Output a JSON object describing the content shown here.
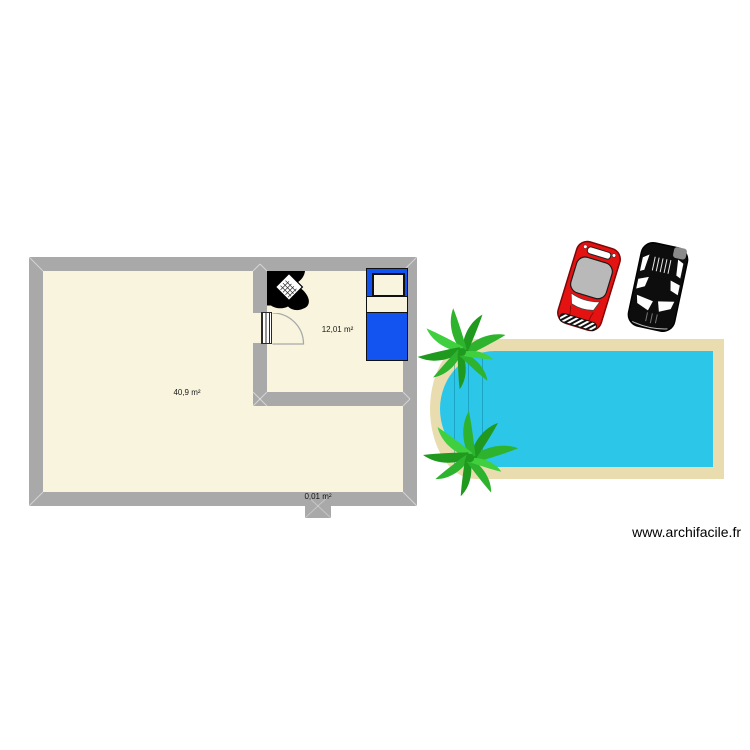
{
  "watermark": {
    "text": "www.archifacile.fr"
  },
  "plan": {
    "rooms": [
      {
        "id": "living",
        "area_label": "40,9 m²"
      },
      {
        "id": "bedroom",
        "area_label": "12,01 m²"
      },
      {
        "id": "stub",
        "area_label": "0,01 m²"
      }
    ],
    "objects": {
      "door": "swing-door",
      "desk": "corner-desk-with-laptop-and-chair",
      "bed": "single-bed",
      "pool": "rounded-end-swimming-pool",
      "palms": "palm-tree",
      "cars": [
        "red-car",
        "black-car"
      ]
    }
  },
  "colors": {
    "wall": "#a9a9a9",
    "floor": "#f8f4dd",
    "pool_water": "#2cc7e8",
    "pool_deck": "#e9ddb0",
    "bed_blue": "#1353ef",
    "palm_green": "#2eb32e",
    "palm_green_dark": "#1f9a1f",
    "palm_green_light": "#3fcf3f",
    "car_red": "#e51212",
    "car_roof_gray": "#b9b9b9",
    "car_black": "#0d0d0d",
    "label_text": "#1a1a1a"
  }
}
